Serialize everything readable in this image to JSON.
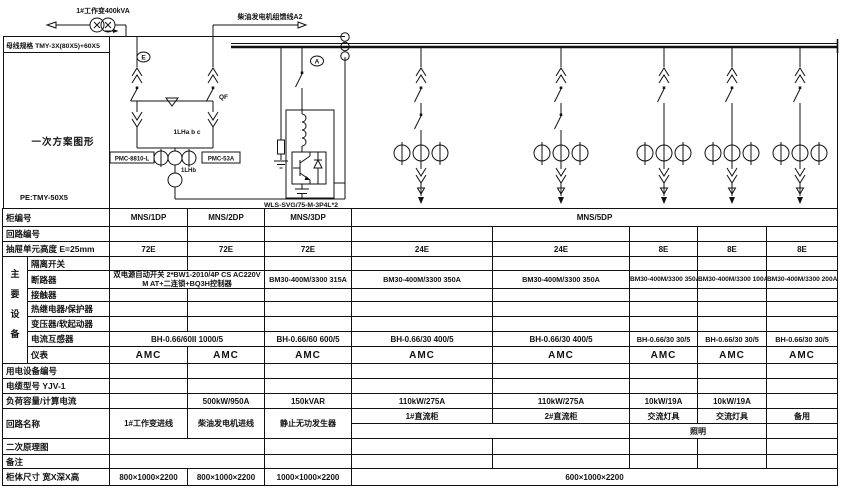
{
  "diagram": {
    "transformer_feeder_label": "1#工作变400kVA",
    "generator_feeder_label": "柴油发电机组馈线A2",
    "busbar_spec": "母线规格 TMY-3X(80X5)+60X5",
    "scheme_title": "一次方案图形",
    "pe_spec": "PE:TMY-50X5",
    "earth_tag": "E",
    "ammeter_tag": "A",
    "breaker_tag": "QF",
    "ct_group_tag": "1LHa b c",
    "ct_b_tag": "1LHb",
    "meter_left": "PMC-8810-L",
    "meter_right": "PMC-53A",
    "svg_device_label": "WLS-SVG/75-M-3P4L*2"
  },
  "labels": {
    "cabinet_no": "柜编号",
    "circuit_no": "回路编号",
    "unit_height": "抽屉单元高度 E=25mm",
    "main_equipment": "主要设备",
    "isolator": "隔离开关",
    "breaker": "断路器",
    "contactor": "接触器",
    "thermal_relay": "热继电器/保护器",
    "transformer_starter": "变压器/软起动器",
    "current_transformer": "电流互感器",
    "meter": "仪表",
    "device_no": "用电设备编号",
    "cable_type": "电缆型号 YJV-1",
    "load_capacity": "负荷容量/计算电流",
    "circuit_name": "回路名称",
    "secondary_diagram": "二次原理图",
    "remarks": "备注",
    "cabinet_size": "柜体尺寸 宽X深X高"
  },
  "cells": {
    "cabinet_no": [
      "MNS/1DP",
      "MNS/2DP",
      "MNS/3DP",
      "MNS/5DP"
    ],
    "unit_height": [
      "72E",
      "72E",
      "72E",
      "24E",
      "24E",
      "8E",
      "8E",
      "8E"
    ],
    "breaker_12_line1": "双电源自动开关 2*BW1-2010/4P CS AC220V",
    "breaker_12_line2": "M AT+二连锁+BQ3H控制器",
    "breaker": [
      "BM30-400M/3300 315A",
      "BM30-400M/3300 350A",
      "BM30-400M/3300 350A",
      "BM30-400M/3300 350A",
      "BM30-400M/3300 100A",
      "BM30-400M/3300 200A"
    ],
    "ct_12": "BH-0.66/60II 1000/5",
    "ct": [
      "BH-0.66/60 600/5",
      "BH-0.66/30 400/5",
      "BH-0.66/30 400/5",
      "BH-0.66/30 30/5",
      "BH-0.66/30 30/5",
      "BH-0.66/30 30/5"
    ],
    "meters": [
      "AMC",
      "AMC",
      "AMC",
      "AMC",
      "AMC",
      "AMC",
      "AMC",
      "AMC"
    ],
    "load": [
      "",
      "500kW/950A",
      "150kVAR",
      "110kW/275A",
      "110kW/275A",
      "10kW/19A",
      "10kW/19A",
      ""
    ],
    "circuit_names": [
      "1#工作变进线",
      "柴油发电机进线",
      "静止无功发生器",
      "1#直流柜",
      "2#直流柜",
      "交流灯具",
      "交流灯具",
      "备用"
    ],
    "lighting": "照明",
    "sizes": [
      "800×1000×2200",
      "800×1000×2200",
      "1000×1000×2200",
      "600×1000×2200"
    ]
  }
}
